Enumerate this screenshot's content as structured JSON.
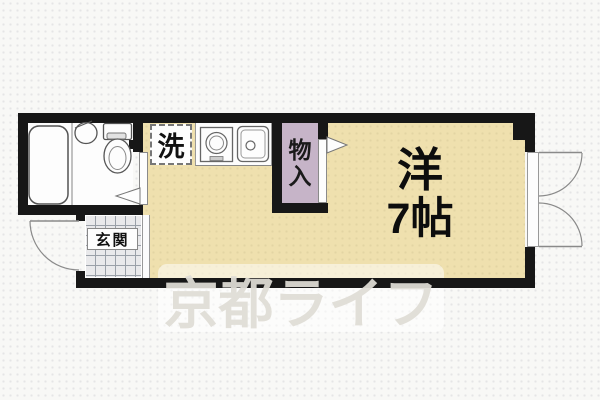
{
  "plan": {
    "type": "floorplan",
    "labels": {
      "laundry": "洗",
      "closet_char_top": "物",
      "closet_char_bottom": "入",
      "entrance": "玄関",
      "room_name": "洋",
      "room_size": "7帖"
    },
    "watermark": "京都ライフ",
    "fixtures": [
      "bathtub",
      "washbasin",
      "toilet",
      "stove-burner",
      "kitchen-sink"
    ],
    "colors": {
      "room_fill": "#efe0ae",
      "closet_fill": "#c6b4c8",
      "tile_fill": "#e9e9eb",
      "tile_line": "#9aa0a8",
      "wall": "#171717",
      "bg": "#f8f8f6",
      "line": "#8a8a8a",
      "watermark_text": "#e0ddd6",
      "watermark_box": "rgba(255,255,255,0.52)"
    }
  }
}
